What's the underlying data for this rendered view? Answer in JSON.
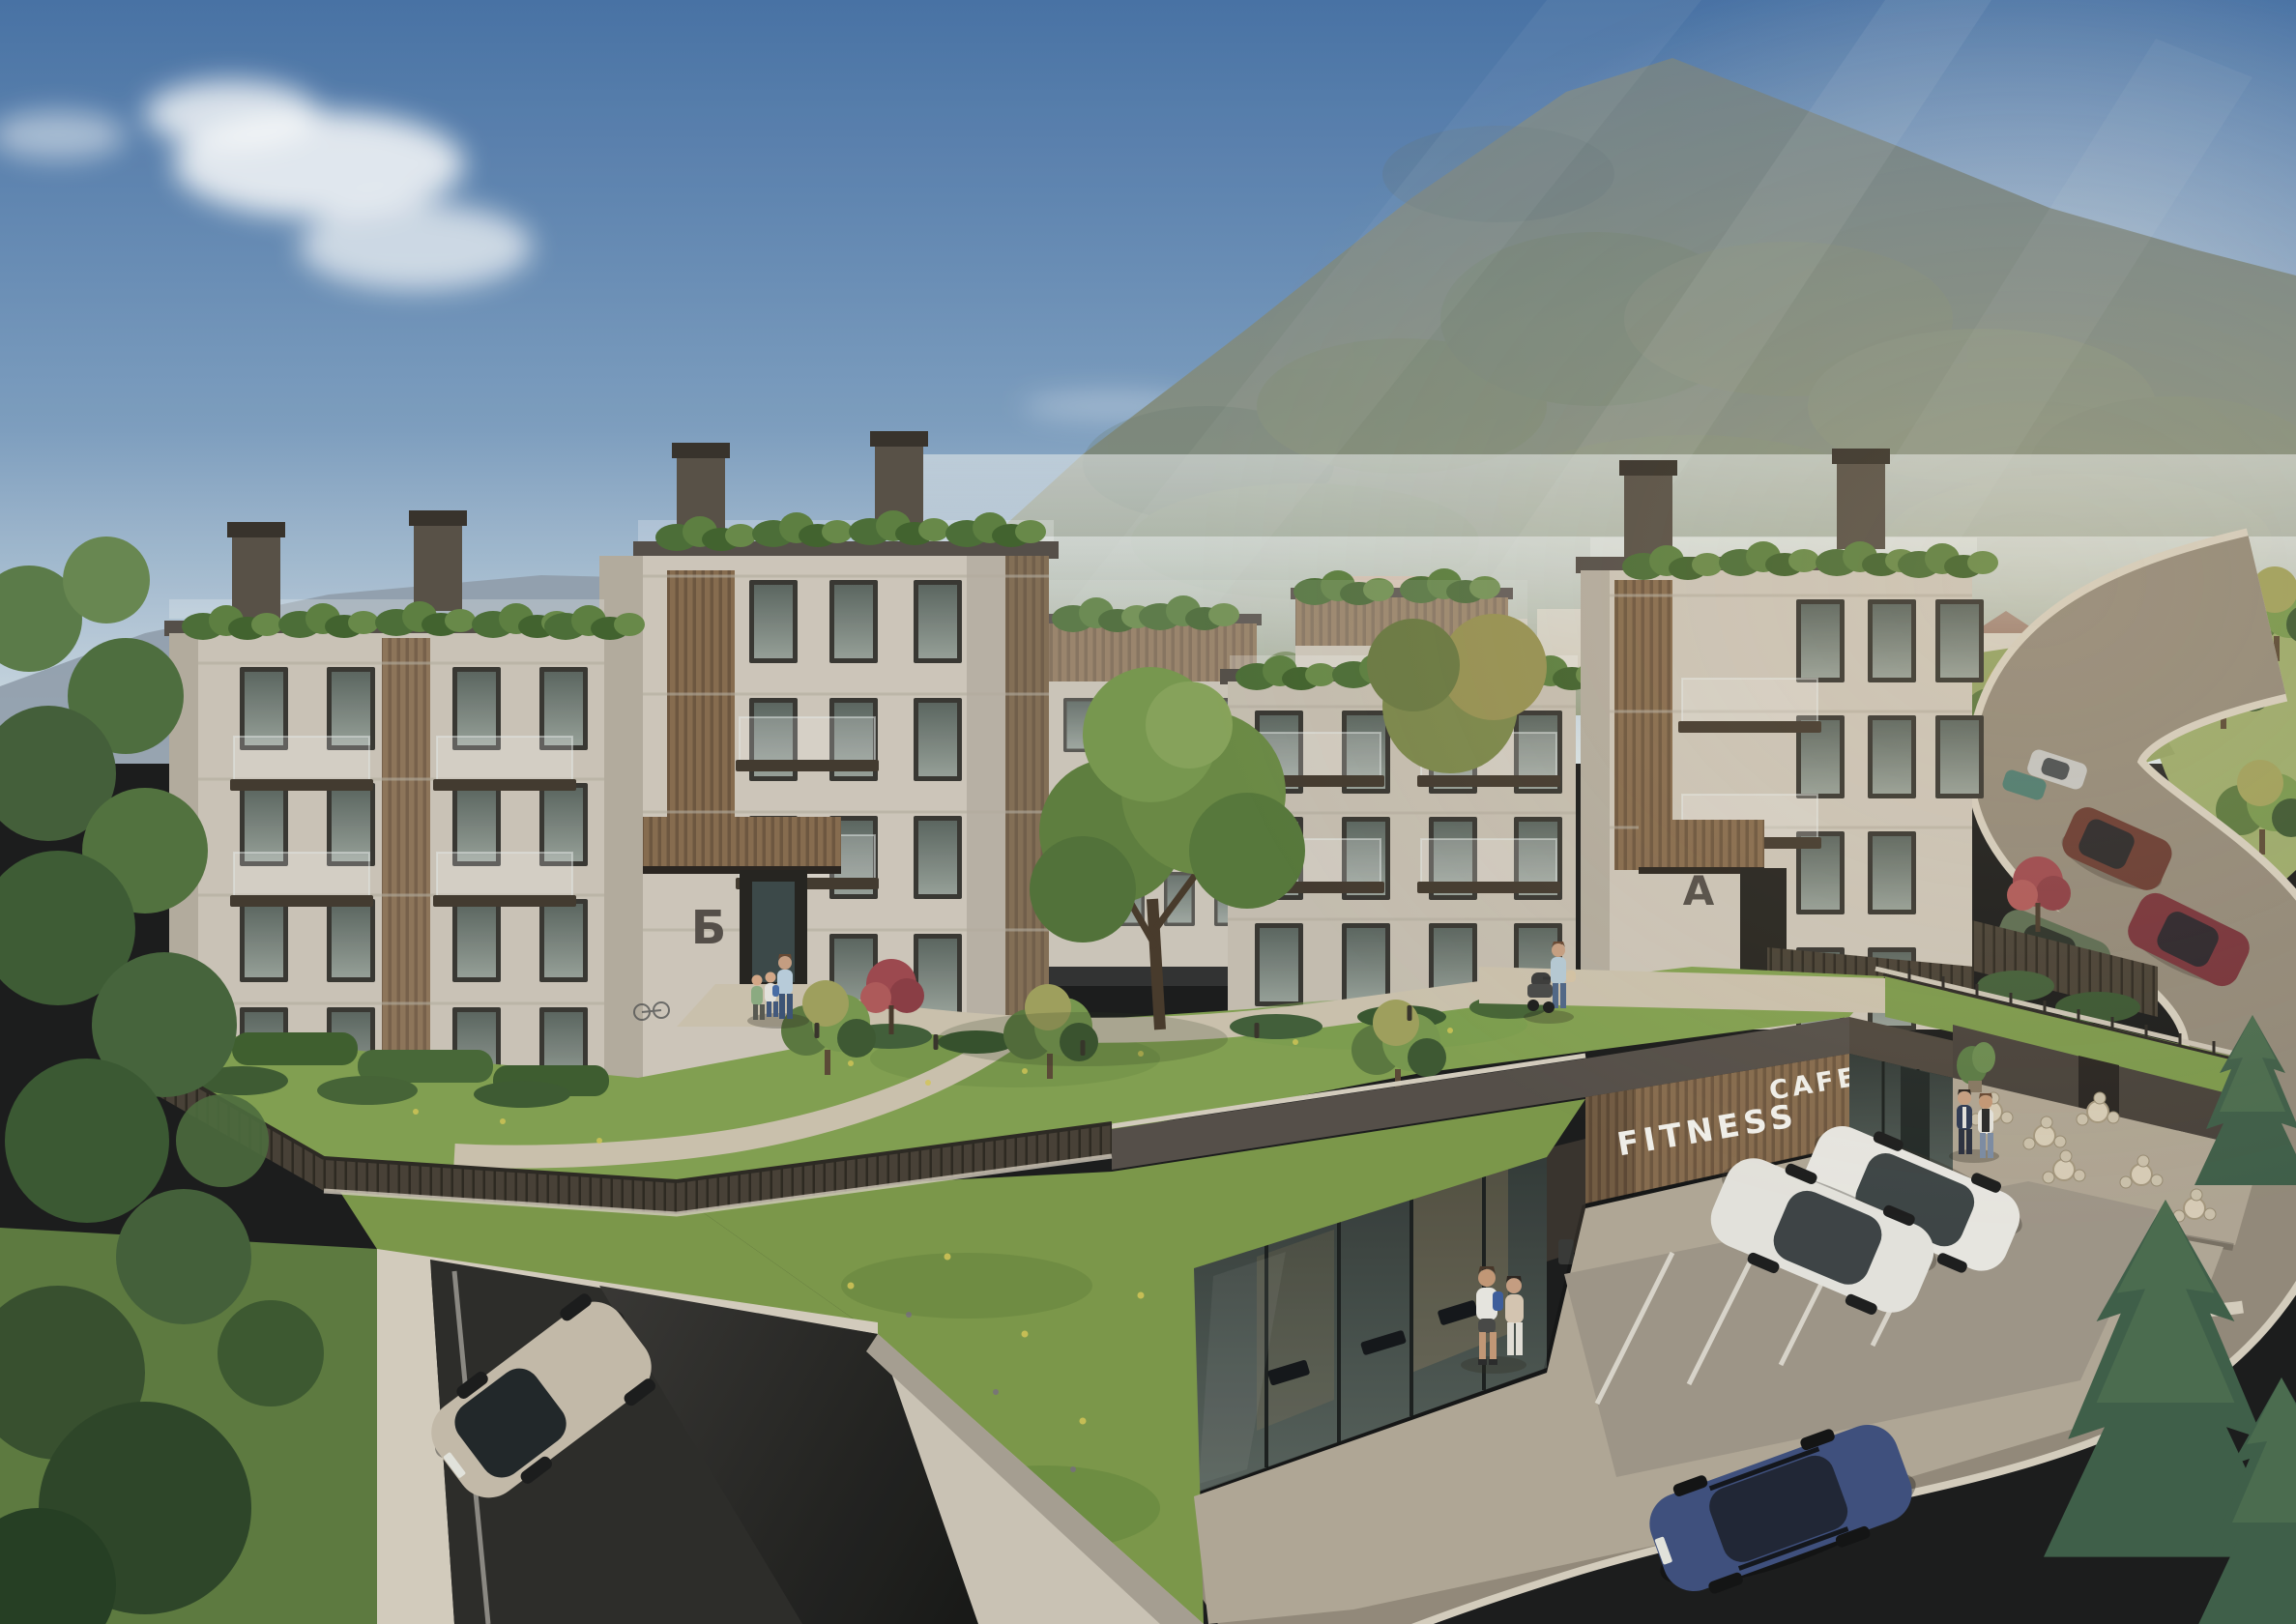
{
  "scene": {
    "signs": {
      "fitness": "FITNESS",
      "cafe": "CAFE"
    },
    "building_labels": {
      "entrance_b": "Б",
      "entrance_a": "A"
    },
    "colors": {
      "sky_top": "#4a74a8",
      "sky_mid": "#7fa0c2",
      "sky_horizon": "#dde6ea",
      "mountain_top": "#75858d",
      "mountain_base": "#9aa287",
      "haze": "#e9edec",
      "facade": "#d2cabd",
      "facade_shade": "#b7afa1",
      "wood": "#8a6e50",
      "trim": "#57504a",
      "glass": "#5e6862",
      "lawn": "#85a352",
      "slope_grass": "#7e9a4b",
      "path": "#cfc5b0",
      "plaza": "#b4aa98",
      "road": "#968c7c",
      "curb": "#d9d1c1",
      "ramp": "#2e2d2a",
      "concrete": "#d8d0c1",
      "sign_text": "#f6f4ef",
      "fence": "#4a4237",
      "tree_dark": "#3f5a33",
      "tree_mid": "#5d7a40",
      "tree_light": "#7a9a50",
      "tree_autumn": "#a3a35e",
      "maple_red": "#a04a50",
      "pine": "#41604a"
    },
    "vehicles": {
      "garage_suv": {
        "color": "#c8bdac"
      },
      "parked_crossover": {
        "color": "#e9e7e0"
      },
      "parked_estate": {
        "color": "#edebe5"
      },
      "road_wagon": {
        "color": "#41517f"
      },
      "distant_suv": {
        "color": "#6b3c33"
      },
      "distant_sedan": {
        "color": "#7a343c"
      },
      "distant_parked_suv": {
        "color": "#5e6e54"
      },
      "distant_hatch": {
        "color": "#4e7d72"
      },
      "distant_silver": {
        "color": "#c7c7c5"
      }
    }
  }
}
